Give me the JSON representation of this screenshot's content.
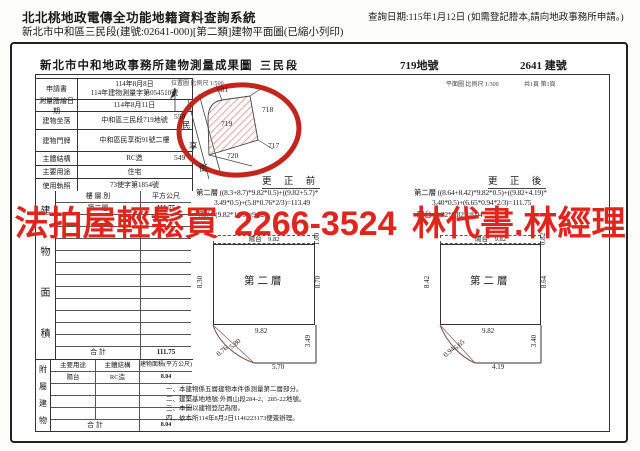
{
  "header": {
    "system_title": "北北桃地政電傳全功能地籍資料查詢系統",
    "doc_subtitle": "新北市中和區三民段(建號:02641-000)[第二類]建物平面圖(已縮小列印)",
    "query_date": "查詢日期:115年1月12日 (如需登記謄本,請向地政事務所申請。)"
  },
  "sheet": {
    "title": "新北市中和地政事務所建物測量成果圖",
    "section_name": "三民段",
    "land_number": "719地號",
    "building_number": "2641 建號",
    "location_scale": "位置圖 比例尺  1/500",
    "plan_scale": "平面圖 比例尺  1/300",
    "page_info": "共1頁 第1頁"
  },
  "info": {
    "rows": [
      {
        "label": "申請書",
        "value": "114年8月8日",
        "value2": "114年建物測量字第054510號"
      },
      {
        "label": "測量謄繪日期",
        "value": "114年8月11日",
        "value2": ""
      },
      {
        "label": "建物坐落",
        "value": "中和區三民段719地號",
        "value2": ""
      },
      {
        "label": "建物門牌",
        "value": "中和區民享街91號二樓",
        "value2": ""
      },
      {
        "label": "主體結構",
        "value": "RC造",
        "value2": ""
      },
      {
        "label": "主要用途",
        "value": "住宅",
        "value2": ""
      },
      {
        "label": "使用執照",
        "value": "73使字第1854號",
        "value2": ""
      }
    ]
  },
  "area": {
    "side_label": "建物面積",
    "col_floor": "樓 層 別",
    "col_sqm": "平方公尺",
    "floor": "第二層",
    "floor_area": "111.75",
    "total_label": "合  計",
    "total": "111.75"
  },
  "annex": {
    "side_label": "附屬建物",
    "col_use": "主要用途",
    "col_structure": "主體結構",
    "col_area": "建物面積(平方公尺)",
    "use": "陽台",
    "structure": "RC造",
    "area_value": "8.04",
    "total_label": "合  計",
    "total": "8.04"
  },
  "before": {
    "title": "更 正 前",
    "formula1": "第二層 ((8.3+8.7)*9.82*0.5)+((9.82+5.7)*",
    "formula2": "3.49*0.5)+(5.8*0.76*2/3)=113.49",
    "formula3": "陽台 (9.82*1.00)=9.82",
    "plan": {
      "balcony": "陽台    9.82",
      "balcony_depth": "1.00",
      "left": "8.30",
      "right": "8.70",
      "floor": "第二層",
      "width": "9.82",
      "lower_right": "3.49",
      "lower_bottom": "5.70",
      "diag_a": "0.76",
      "diag_b": "5.80"
    }
  },
  "after": {
    "title": "更 正 後",
    "formula1": "第二層 ((8.64+8.42)*9.82*0.5)+((9.82+4.19)*",
    "formula2": "3.40*0.5)+(6.65*0.94*2/3)=111.75",
    "formula3": "陽台 (9.82*0.82)=8.04",
    "plan": {
      "balcony": "陽台    9.82",
      "balcony_depth": "0.82",
      "left": "8.42",
      "right": "8.64",
      "floor": "第二層",
      "width": "9.82",
      "lower_right": "3.40",
      "lower_bottom": "4.19",
      "diag_a": "0.94",
      "diag_b": "6.65"
    }
  },
  "site_map": {
    "parcel_center": "719",
    "parcel_top": "681",
    "parcel_right": "718",
    "parcel_bottom_right": "717",
    "parcel_bottom": "720",
    "parcel_left_top": "550",
    "parcel_left_bottom": "549",
    "street_chars": [
      "民",
      "享",
      "街"
    ]
  },
  "notes": [
    "一、本建物係五層建物本件係測量第二層部分。",
    "二、建築基地地號:外員山段284-2、285-22地號。",
    "三、本圖以建物登記為限。",
    "四、依本所114年8月2日1146223173便簽辦理。"
  ],
  "watermark": {
    "text": "法拍屋輕鬆買 2266-3524 林代書.林經理",
    "color": "#e0251c"
  }
}
